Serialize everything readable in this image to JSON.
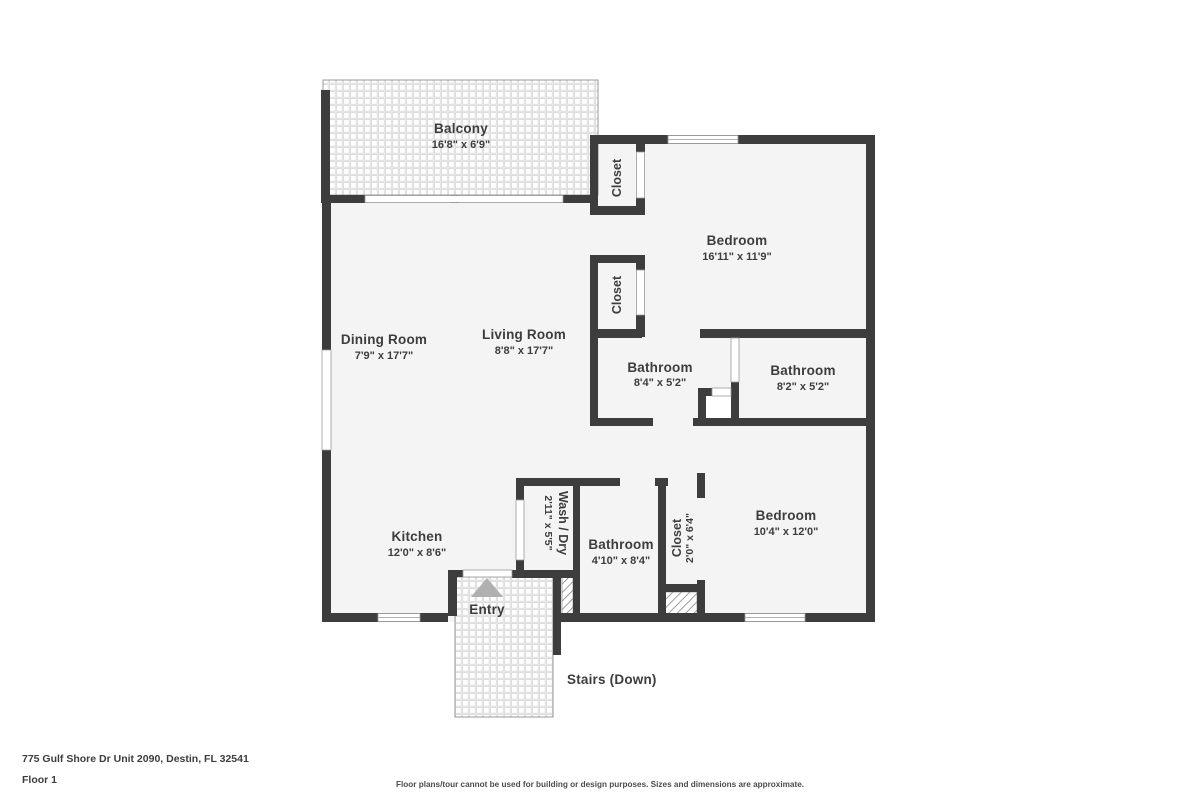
{
  "floor_plan": {
    "rooms": {
      "balcony": {
        "name": "Balcony",
        "dims": "16'8\" x 6'9\""
      },
      "dining_room": {
        "name": "Dining Room",
        "dims": "7'9\" x 17'7\""
      },
      "living_room": {
        "name": "Living Room",
        "dims": "8'8\" x 17'7\""
      },
      "kitchen": {
        "name": "Kitchen",
        "dims": "12'0\" x 8'6\""
      },
      "bedroom_top": {
        "name": "Bedroom",
        "dims": "16'11\" x 11'9\""
      },
      "bathroom_left": {
        "name": "Bathroom",
        "dims": "8'4\" x 5'2\""
      },
      "bathroom_right": {
        "name": "Bathroom",
        "dims": "8'2\" x 5'2\""
      },
      "bedroom_bottom": {
        "name": "Bedroom",
        "dims": "10'4\" x 12'0\""
      },
      "bathroom_lower": {
        "name": "Bathroom",
        "dims": "4'10\" x 8'4\""
      },
      "wash_dry": {
        "name": "Wash / Dry",
        "dims": "2'11\" x 5'5\""
      },
      "closet_upper": {
        "name": "Closet"
      },
      "closet_mid": {
        "name": "Closet"
      },
      "closet_bedroom": {
        "name": "Closet",
        "dims": "2'0\" x 6'4\""
      },
      "entry": {
        "name": "Entry"
      },
      "stairs": {
        "name": "Stairs (Down)"
      }
    },
    "footer": {
      "address": "775 Gulf Shore Dr Unit 2090, Destin, FL 32541",
      "floor_label": "Floor 1",
      "disclaimer": "Floor plans/tour cannot be used for building or design purposes. Sizes and dimensions are approximate."
    },
    "colors": {
      "wall": "#3d3d3d",
      "floor": "#f4f4f4",
      "text": "#3d3d3d",
      "entry_arrow": "#b0b0b0"
    }
  }
}
